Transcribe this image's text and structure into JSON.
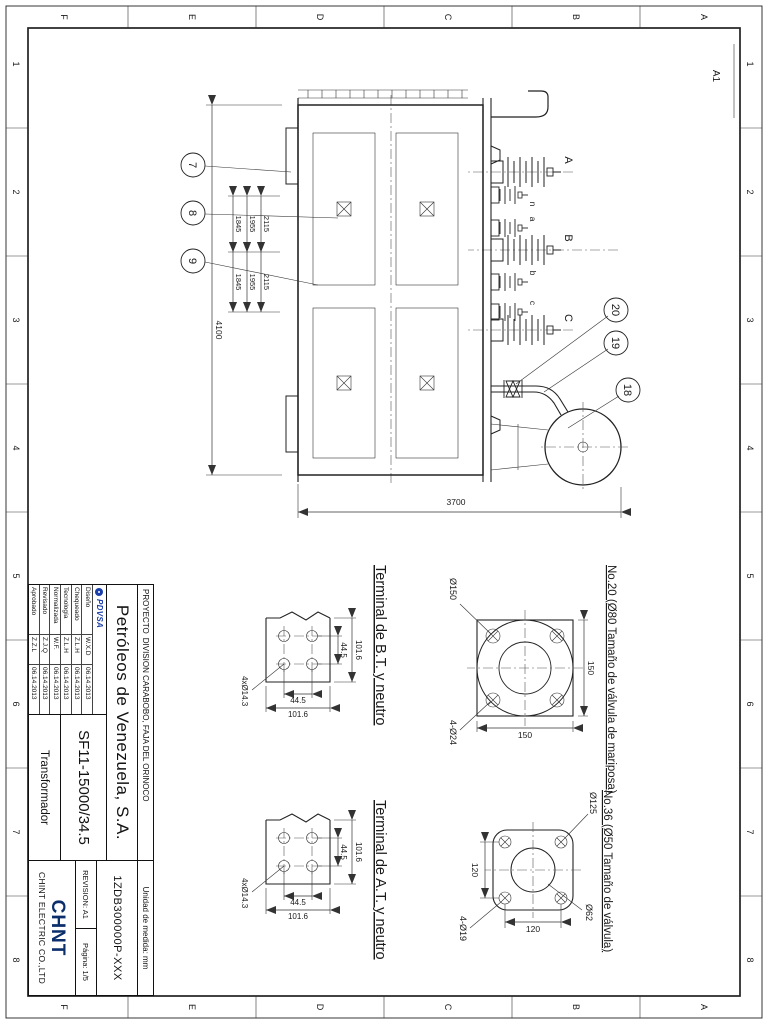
{
  "sheet": {
    "size_label": "A1",
    "zones": {
      "cols": [
        "1",
        "2",
        "3",
        "4",
        "5",
        "6",
        "7",
        "8"
      ],
      "rows": [
        "A",
        "B",
        "C",
        "D",
        "E",
        "F"
      ]
    }
  },
  "title_block": {
    "project_label": "PROYECTO",
    "project": "DIVISION CARABOBO, FAJA DEL ORINOCO",
    "units": "Unidad de medida: mm",
    "company": "Petróleos de Venezuela, S.A.",
    "drawing_number": "1ZDB300000P-XXX",
    "model": "SF11-15000/34.5",
    "product_name": "Transformador",
    "revision": "REVISION: A1",
    "page": "Página: 1/5",
    "customer_logo": "PDVSA",
    "manufacturer_logo": "CHNT",
    "manufacturer": "CHINT ELECTRIC CO.,LTD",
    "approvals": [
      {
        "role": "Diseño",
        "name": "W.X.D",
        "date": "06.14.2013"
      },
      {
        "role": "Chequeado",
        "name": "Z.L.H",
        "date": "06.14.2013"
      },
      {
        "role": "Tecnología",
        "name": "Z.L.H",
        "date": "06.14.2013"
      },
      {
        "role": "Normalizada",
        "name": "W.F.",
        "date": "06.14.2013"
      },
      {
        "role": "Revisado",
        "name": "Z.J.Q",
        "date": "06.14.2013"
      },
      {
        "role": "Aprobado",
        "name": "Z.Z.L",
        "date": "06.14.2013"
      }
    ]
  },
  "drawing": {
    "hv_labels": [
      "A",
      "B",
      "C"
    ],
    "lv_labels": [
      "n",
      "a",
      "b",
      "c"
    ],
    "callouts": [
      "7",
      "8",
      "9",
      "18",
      "19",
      "20"
    ],
    "dims": {
      "overall_length": "4100",
      "overall_height": "3700",
      "spacings": [
        "2115",
        "1955",
        "1845"
      ]
    }
  },
  "details": {
    "bt": {
      "caption": "Terminal de B.T. y neutro",
      "outer": "101.6",
      "pitch": "44.5",
      "holes": "4xØ14.3"
    },
    "at": {
      "caption": "Terminal de A.T. y neutro",
      "outer": "101.6",
      "pitch": "44.5",
      "holes": "4xØ14.3"
    },
    "valve80": {
      "caption": "No.20 (Ø80 Tamaño de válvula de mariposa)",
      "side_top": "150",
      "side_right": "150",
      "flange": "Ø150",
      "holes": "4-Ø24"
    },
    "valve50": {
      "caption": "No.36 (Ø50 Tamaño de válvula)",
      "flange": "Ø125",
      "bore": "Ø62",
      "pitch_v": "120",
      "pitch_h": "120",
      "holes": "4-Ø19"
    }
  },
  "colors": {
    "line": "#1a1a1a",
    "pdvsa_blue": "#1b3faa",
    "chint_navy": "#0c2f6b"
  }
}
